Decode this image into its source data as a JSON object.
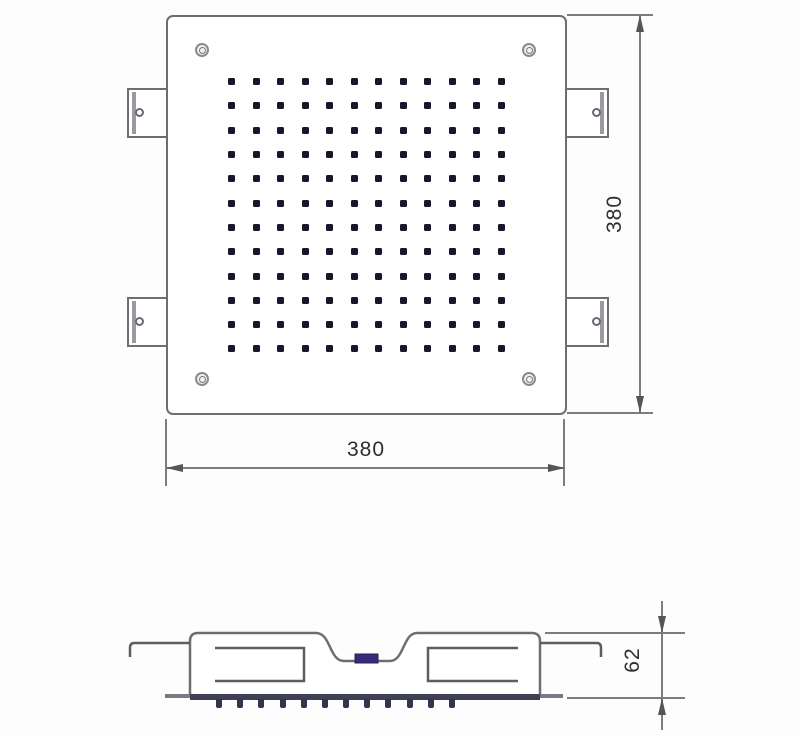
{
  "diagram": {
    "type": "technical-drawing",
    "views": {
      "top_view": {
        "name": "top-view",
        "width_label": "380",
        "height_label": "380",
        "nozzle_rows": 12,
        "nozzle_cols": 12,
        "corner_screw_count": 4,
        "mounting_tab_count": 4
      },
      "side_view": {
        "name": "side-view",
        "height_label": "62",
        "nozzle_count": 12
      }
    },
    "colors": {
      "background": "#fdfdfd",
      "line": "#6e6e6e",
      "nozzle_dot": "#17172b",
      "inlet_accent": "#3a2a7e",
      "nozzle_stub": "#34344e",
      "dim_text": "#2e2e2e"
    }
  }
}
